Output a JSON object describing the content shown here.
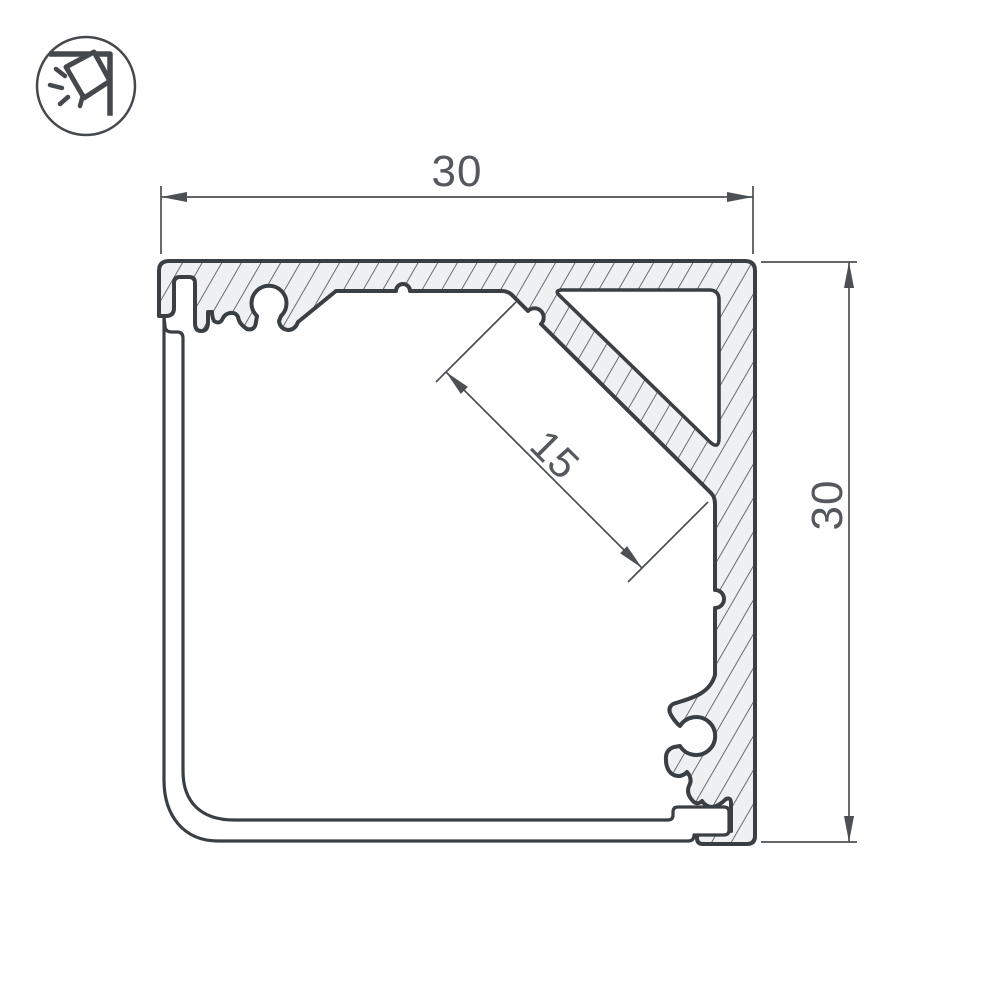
{
  "icon": {
    "name": "corner-light-icon"
  },
  "dimensions": {
    "top_width": "30",
    "right_height": "30",
    "diagonal_channel": "15"
  },
  "colors": {
    "background": "#ffffff",
    "outline": "#3a3f44",
    "hatch_line": "#51565b",
    "aluminum_fill": "#eff0f1",
    "interior_fill": "#ffffff",
    "dimension_line": "#4b5055",
    "dimension_text": "#55585c",
    "icon_stroke": "#45494e"
  }
}
